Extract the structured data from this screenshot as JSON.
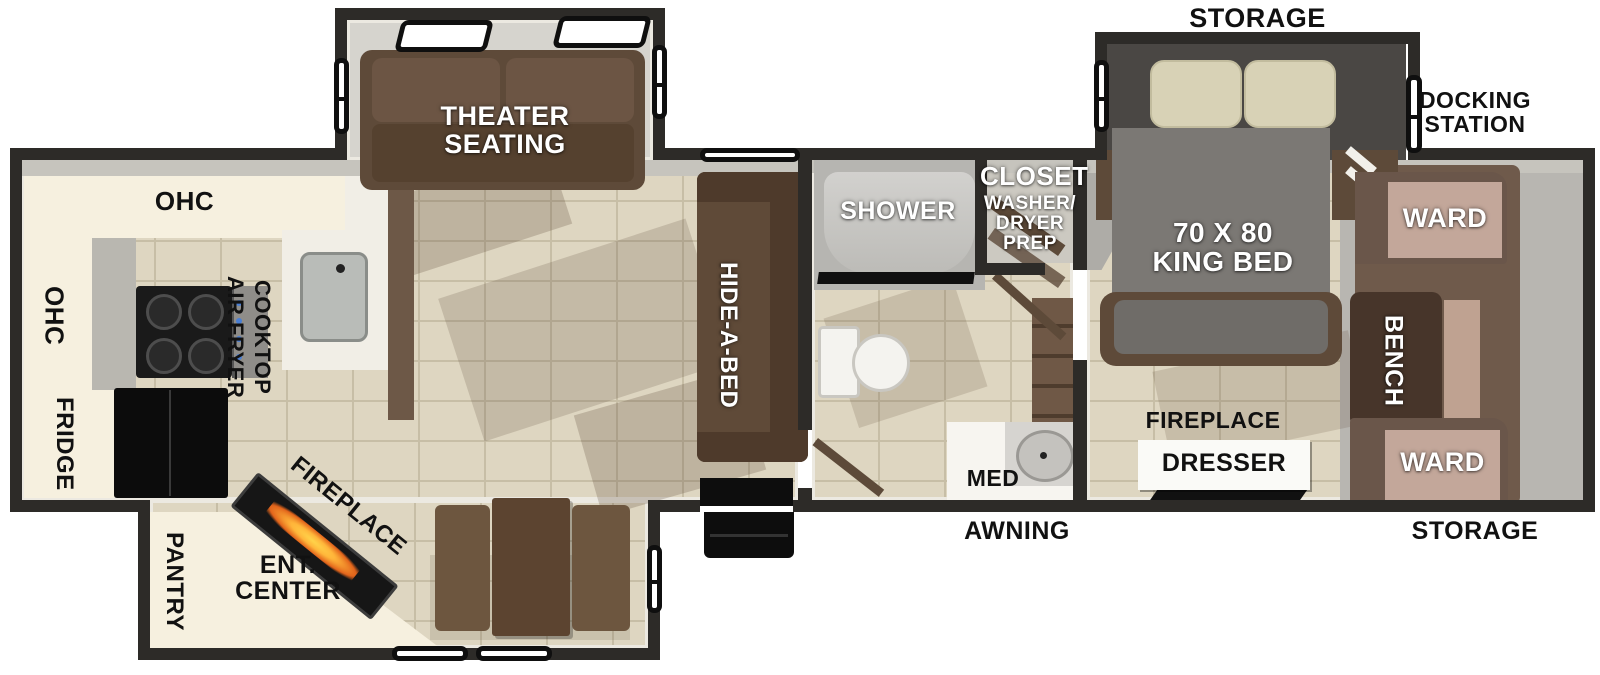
{
  "floorplan": {
    "exterior": {
      "storage_top": "STORAGE",
      "docking_line1": "DOCKING",
      "docking_line2": "STATION",
      "awning": "AWNING",
      "storage_bottom": "STORAGE"
    },
    "living": {
      "theater_line1": "THEATER",
      "theater_line2": "SEATING",
      "hide_a_bed": "HIDE-A-BED"
    },
    "kitchen": {
      "ohc_top": "OHC",
      "ohc_side": "OHC",
      "fridge": "FRIDGE",
      "air_fryer": "AIR FRYER",
      "cooktop": "COOKTOP",
      "pantry": "PANTRY",
      "ent_line1": "ENT.",
      "ent_line2": "CENTER",
      "fireplace": "FIREPLACE"
    },
    "bathroom": {
      "shower": "SHOWER",
      "closet": "CLOSET",
      "wd_line1": "WASHER/",
      "wd_line2": "DRYER",
      "wd_line3": "PREP",
      "med": "MED"
    },
    "bedroom": {
      "bed_line1": "70 X 80",
      "bed_line2": "KING BED",
      "ward_top": "WARD",
      "bench": "BENCH",
      "ward_bottom": "WARD",
      "fireplace": "FIREPLACE",
      "dresser": "DRESSER"
    },
    "colors": {
      "wall": "#2d2b28",
      "floor_tile": "#ded6c1",
      "tile_grout": "#c7bea6",
      "cabinet_cream": "#f6f0df",
      "counter_white": "#f1eee6",
      "sofa_brown": "#5e4a39",
      "wood_dark_brown": "#47352a",
      "ward_pink": "#c3a79a",
      "bed_gray": "#7b7874",
      "pillow_tan": "#d8d2b6",
      "flame_orange": "#ffb53a",
      "appliance_black": "#0c0c0c",
      "front_cap_gray": "#b8b6b1"
    }
  }
}
